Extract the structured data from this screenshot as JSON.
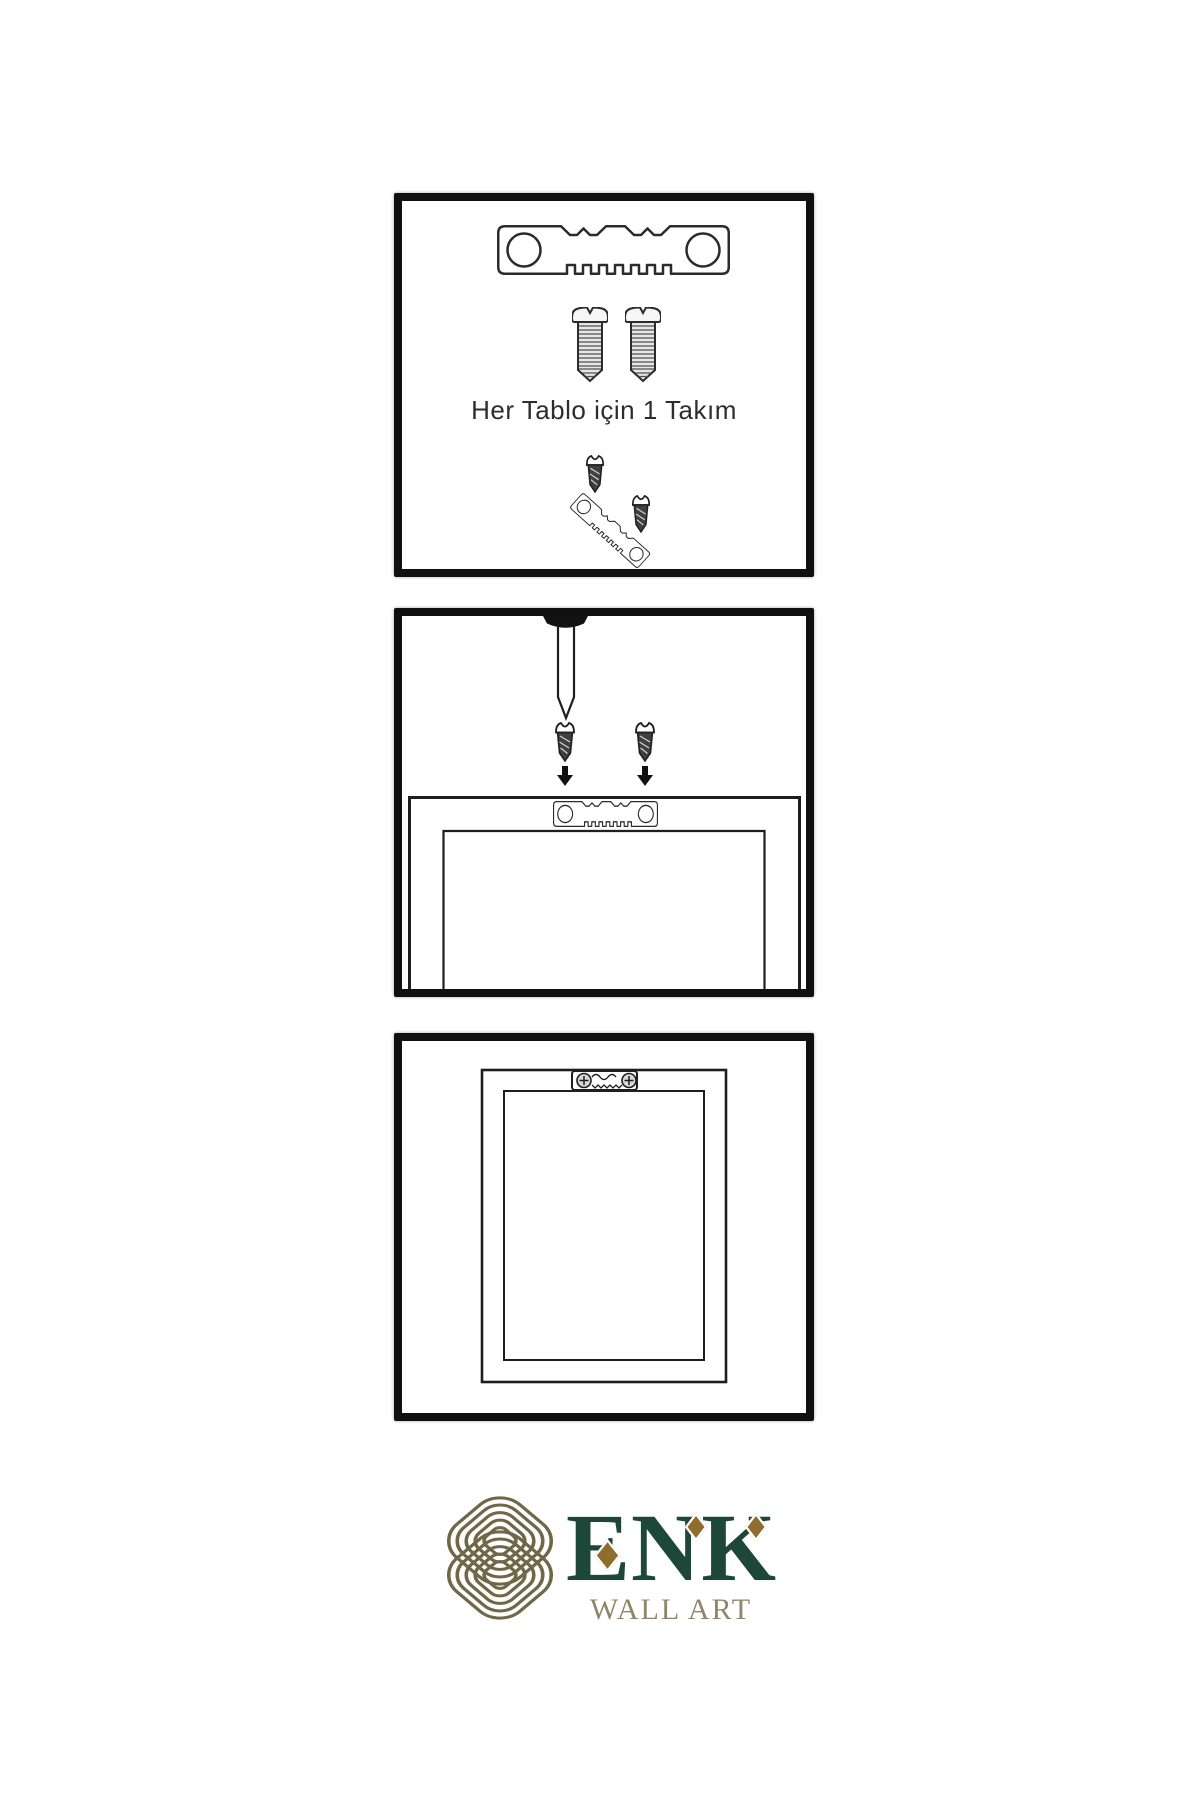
{
  "page": {
    "background": "#ffffff"
  },
  "steps": [
    {
      "name": "hardware-kit",
      "caption": "Her Tablo için 1 Takım"
    },
    {
      "name": "wall-installation",
      "caption": ""
    },
    {
      "name": "frame-mounted",
      "caption": ""
    }
  ],
  "logo": {
    "brand": "ENK",
    "tagline": "WALL ART"
  },
  "colors": {
    "line_ink": "#1e1e1e",
    "panel_border": "#101010",
    "brand_green": "#1d4839",
    "accent_gold": "#8e6d2d",
    "tagline_tan": "#8f8568",
    "knot_olive": "#6f6747"
  },
  "icons": {
    "sawtooth-hanger": "toothed metal hanger plate with two holes",
    "screw": "threaded screw with slotted pan head",
    "dark-screw": "small dark wood screw",
    "nail": "wall nail with black head",
    "down-arrow": "solid downward arrow",
    "frame-back": "rear view of picture frame",
    "knot-logo": "interlaced rounded-square knot"
  }
}
